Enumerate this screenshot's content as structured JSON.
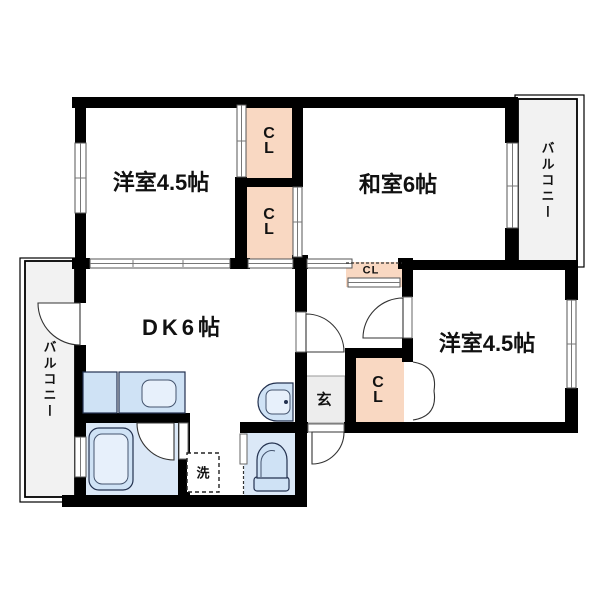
{
  "floorplan": {
    "rooms": {
      "western_room_top": {
        "label": "洋室4.5帖"
      },
      "japanese_room": {
        "label": "和室6帖"
      },
      "dining_kitchen": {
        "label": "DK6帖"
      },
      "western_room_right": {
        "label": "洋室4.5帖"
      }
    },
    "balconies": {
      "left": {
        "label": "バルコニー"
      },
      "right": {
        "label": "バルコニー"
      }
    },
    "closets": {
      "top": {
        "lines": [
          "C",
          "L"
        ]
      },
      "middle": {
        "lines": [
          "C",
          "L"
        ]
      },
      "right": {
        "lines": [
          "C",
          "L"
        ]
      },
      "hall_small": {
        "label": "CL"
      }
    },
    "entrance": {
      "label": "玄"
    },
    "laundry": {
      "label": "洗"
    },
    "colors": {
      "wall": "#000000",
      "closet": "#f9d8c2",
      "balcony": "#f2f2f2",
      "genkan": "#ededed",
      "wet_floor": "#dbe8f7",
      "fixture": "#cfe2f5",
      "fixture_inner": "#e7f0fb"
    }
  }
}
